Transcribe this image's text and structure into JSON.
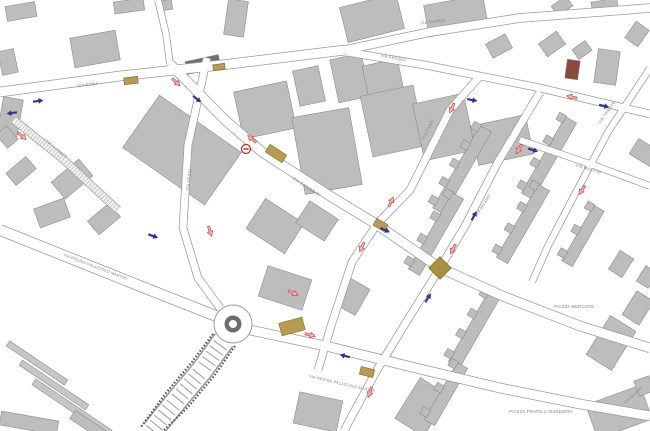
{
  "map": {
    "canvas": {
      "w": 650,
      "h": 431,
      "bg": "#ffffff"
    },
    "palette": {
      "building_fill": "#bdbdbd",
      "building_stroke": "#878787",
      "road_casing": "#9a9a9a",
      "road_fill": "#ffffff",
      "marker_gold": "#b89a50",
      "marker_gold_dark": "#a98f3c",
      "arrow_blue": "#2b3990",
      "arrow_red_fill": "#f2b3b3",
      "arrow_red_stroke": "#cf3333",
      "label_color": "#808080",
      "roundabout_ring": "#6e6e6e"
    },
    "roads": [
      {
        "id": "via-roma",
        "pts": [
          [
            0,
            92
          ],
          [
            120,
            76
          ],
          [
            230,
            64
          ],
          [
            345,
            50
          ]
        ],
        "w": 9
      },
      {
        "id": "via-suardi",
        "pts": [
          [
            345,
            50
          ],
          [
            430,
            32
          ],
          [
            520,
            18
          ],
          [
            650,
            8
          ]
        ],
        "w": 8
      },
      {
        "id": "via-reggio",
        "pts": [
          [
            347,
            52
          ],
          [
            430,
            66
          ],
          [
            540,
            88
          ],
          [
            650,
            114
          ]
        ],
        "w": 7
      },
      {
        "id": "via-garibaldi-main",
        "pts": [
          [
            170,
            64
          ],
          [
            225,
            120
          ],
          [
            262,
            152
          ],
          [
            330,
            196
          ],
          [
            376,
            224
          ],
          [
            440,
            268
          ],
          [
            505,
            297
          ],
          [
            580,
            326
          ],
          [
            650,
            348
          ]
        ],
        "w": 9
      },
      {
        "id": "via-verdi",
        "pts": [
          [
            207,
            58
          ],
          [
            188,
            145
          ],
          [
            183,
            228
          ],
          [
            198,
            278
          ],
          [
            220,
            308
          ]
        ],
        "w": 7
      },
      {
        "id": "via-fiume",
        "pts": [
          [
            480,
            76
          ],
          [
            450,
            110
          ],
          [
            410,
            190
          ],
          [
            377,
            224
          ],
          [
            352,
            262
          ],
          [
            331,
            326
          ],
          [
            318,
            370
          ]
        ],
        "w": 7
      },
      {
        "id": "via-milano",
        "pts": [
          [
            540,
            92
          ],
          [
            498,
            162
          ],
          [
            465,
            226
          ],
          [
            440,
            268
          ],
          [
            410,
            316
          ],
          [
            377,
            370
          ],
          [
            354,
            412
          ],
          [
            344,
            431
          ]
        ],
        "w": 7
      },
      {
        "id": "via-trieste",
        "pts": [
          [
            650,
            68
          ],
          [
            608,
            132
          ],
          [
            574,
            196
          ],
          [
            548,
            246
          ],
          [
            532,
            282
          ]
        ],
        "w": 6
      },
      {
        "id": "via-mazzini",
        "pts": [
          [
            520,
            140
          ],
          [
            590,
            164
          ],
          [
            650,
            186
          ]
        ],
        "w": 6
      },
      {
        "id": "via-regina-west",
        "pts": [
          [
            0,
            230
          ],
          [
            80,
            262
          ],
          [
            150,
            290
          ],
          [
            216,
            316
          ]
        ],
        "w": 10
      },
      {
        "id": "via-regina-east",
        "pts": [
          [
            250,
            330
          ],
          [
            330,
            347
          ],
          [
            420,
            369
          ],
          [
            500,
            388
          ],
          [
            580,
            404
          ],
          [
            650,
            416
          ]
        ],
        "w": 9
      },
      {
        "id": "north-stub",
        "pts": [
          [
            158,
            0
          ],
          [
            166,
            34
          ],
          [
            170,
            64
          ]
        ],
        "w": 6
      }
    ],
    "stair_street": {
      "pts": [
        [
          14,
          120
        ],
        [
          64,
          160
        ],
        [
          118,
          210
        ]
      ],
      "w": 7,
      "step": 3,
      "rung": 7
    },
    "bridge": {
      "pts": [
        [
          224,
          340
        ],
        [
          203,
          369
        ],
        [
          177,
          400
        ],
        [
          152,
          431
        ]
      ],
      "w": 20,
      "step": 6.5,
      "rung": 16,
      "rails": [
        [
          [
            213,
            334
          ],
          [
            192,
            362
          ],
          [
            166,
            393
          ],
          [
            141,
            427
          ]
        ],
        [
          [
            235,
            346
          ],
          [
            214,
            376
          ],
          [
            188,
            407
          ],
          [
            163,
            431
          ]
        ]
      ]
    },
    "roundabout": {
      "cx": 233,
      "cy": 324,
      "r_outer": 19,
      "r_ring": 8.5,
      "r_inner": 4
    },
    "buildings": [
      [
        6,
        4,
        30,
        15,
        -10
      ],
      [
        114,
        0,
        30,
        12,
        -8
      ],
      [
        72,
        34,
        46,
        30,
        -10
      ],
      [
        0,
        50,
        16,
        24,
        -12
      ],
      [
        226,
        0,
        20,
        36,
        8
      ],
      [
        160,
        0,
        12,
        10,
        -8
      ],
      [
        132,
        118,
        100,
        64,
        35
      ],
      [
        186,
        58,
        34,
        13,
        -12,
        "#6f6f6f"
      ],
      [
        238,
        86,
        54,
        48,
        -12
      ],
      [
        296,
        68,
        26,
        36,
        -12
      ],
      [
        343,
        0,
        58,
        36,
        -14
      ],
      [
        426,
        0,
        60,
        32,
        -10
      ],
      [
        334,
        56,
        32,
        44,
        -12
      ],
      [
        366,
        62,
        36,
        42,
        -12
      ],
      [
        488,
        38,
        22,
        16,
        -28
      ],
      [
        541,
        36,
        22,
        16,
        -35
      ],
      [
        574,
        44,
        16,
        12,
        -35
      ],
      [
        566,
        60,
        13,
        19,
        8,
        "#8a4a3c"
      ],
      [
        596,
        50,
        22,
        34,
        8
      ],
      [
        553,
        0,
        18,
        12,
        -35
      ],
      [
        592,
        0,
        26,
        14,
        -10
      ],
      [
        627,
        26,
        20,
        16,
        -55
      ],
      [
        636,
        140,
        18,
        26,
        -58
      ],
      [
        298,
        112,
        58,
        78,
        -10
      ],
      [
        366,
        90,
        54,
        62,
        -12
      ],
      [
        418,
        98,
        52,
        58,
        -12
      ],
      [
        474,
        120,
        56,
        40,
        -12
      ],
      [
        252,
        208,
        46,
        36,
        33
      ],
      [
        262,
        272,
        46,
        32,
        18
      ],
      [
        300,
        208,
        34,
        26,
        33
      ],
      [
        0,
        98,
        20,
        40,
        10
      ],
      [
        8,
        163,
        26,
        16,
        -40
      ],
      [
        54,
        168,
        36,
        22,
        -40
      ],
      [
        90,
        210,
        28,
        18,
        -40
      ],
      [
        0,
        128,
        14,
        18,
        -40
      ],
      [
        36,
        203,
        32,
        20,
        -20
      ],
      [
        2,
        360,
        70,
        6,
        34,
        "#c6c6c6"
      ],
      [
        14,
        382,
        80,
        6,
        34,
        "#c6c6c6"
      ],
      [
        26,
        404,
        92,
        7,
        34,
        "#c6c6c6"
      ],
      [
        0,
        416,
        58,
        14,
        10
      ],
      [
        68,
        424,
        52,
        10,
        34
      ],
      [
        296,
        396,
        44,
        32,
        12
      ],
      [
        398,
        390,
        48,
        34,
        -58
      ],
      [
        590,
        394,
        58,
        36,
        -20
      ],
      [
        636,
        378,
        16,
        16,
        -20
      ],
      [
        588,
        328,
        46,
        30,
        -58
      ],
      [
        624,
        298,
        28,
        20,
        -58
      ],
      [
        610,
        256,
        22,
        16,
        -58
      ],
      [
        638,
        270,
        18,
        14,
        -58
      ],
      [
        338,
        286,
        30,
        22,
        -60
      ]
    ],
    "comb_buildings": [
      {
        "cx": 462,
        "cy": 170,
        "len": 95,
        "w": 13,
        "rot": -60,
        "teeth": 5
      },
      {
        "cx": 436,
        "cy": 234,
        "len": 88,
        "w": 13,
        "rot": -60,
        "teeth": 4
      },
      {
        "cx": 549,
        "cy": 158,
        "len": 88,
        "w": 13,
        "rot": -60,
        "teeth": 4
      },
      {
        "cx": 523,
        "cy": 224,
        "len": 84,
        "w": 13,
        "rot": -60,
        "teeth": 4
      },
      {
        "cx": 583,
        "cy": 236,
        "len": 64,
        "w": 12,
        "rot": -60,
        "teeth": 3
      },
      {
        "cx": 474,
        "cy": 330,
        "len": 80,
        "w": 13,
        "rot": -60,
        "teeth": 4
      },
      {
        "cx": 446,
        "cy": 394,
        "len": 66,
        "w": 12,
        "rot": -60,
        "teeth": 3
      }
    ],
    "crossing_markers": [
      [
        124,
        77,
        14,
        7,
        -7
      ],
      [
        213,
        64,
        12,
        6,
        -8
      ],
      [
        266,
        149,
        20,
        9,
        33
      ],
      [
        374,
        221,
        13,
        8,
        30
      ],
      [
        280,
        320,
        24,
        13,
        -15
      ],
      [
        360,
        368,
        14,
        8,
        14
      ]
    ],
    "junction_diamond": {
      "cx": 440,
      "cy": 268,
      "size": 16
    },
    "arrows": [
      [
        38,
        101,
        -8,
        "blue"
      ],
      [
        12,
        113,
        172,
        "blue"
      ],
      [
        22,
        136,
        40,
        "red"
      ],
      [
        176,
        82,
        42,
        "red"
      ],
      [
        197,
        99,
        38,
        "blue"
      ],
      [
        252,
        139,
        218,
        "red"
      ],
      [
        385,
        230,
        24,
        "blue"
      ],
      [
        391,
        202,
        -65,
        "red"
      ],
      [
        362,
        247,
        115,
        "red"
      ],
      [
        453,
        249,
        118,
        "red"
      ],
      [
        474,
        216,
        -62,
        "blue"
      ],
      [
        452,
        108,
        115,
        "red"
      ],
      [
        472,
        100,
        11,
        "blue"
      ],
      [
        533,
        150,
        16,
        "blue"
      ],
      [
        519,
        149,
        122,
        "red"
      ],
      [
        604,
        106,
        13,
        "blue"
      ],
      [
        572,
        97,
        193,
        "red"
      ],
      [
        210,
        231,
        72,
        "red"
      ],
      [
        153,
        236,
        20,
        "blue"
      ],
      [
        293,
        293,
        25,
        "red"
      ],
      [
        310,
        335,
        14,
        "red"
      ],
      [
        345,
        356,
        194,
        "blue"
      ],
      [
        370,
        392,
        108,
        "red"
      ],
      [
        582,
        190,
        122,
        "red"
      ],
      [
        428,
        298,
        -58,
        "blue"
      ]
    ],
    "no_entry_signs": [
      {
        "x": 246,
        "y": 149
      }
    ],
    "labels": [
      {
        "t": "VIA ROMA",
        "x": 88,
        "y": 86,
        "r": -7,
        "s": 4
      },
      {
        "t": "VIA SUARDI",
        "x": 433,
        "y": 23,
        "r": -7,
        "s": 4
      },
      {
        "t": "VIA REGGIO",
        "x": 393,
        "y": 59,
        "r": 11,
        "s": 4
      },
      {
        "t": "VIA GARIBALDI",
        "x": 306,
        "y": 188,
        "r": 33,
        "s": 4
      },
      {
        "t": "VIA FIUME",
        "x": 429,
        "y": 130,
        "r": -63,
        "s": 4
      },
      {
        "t": "VIA MILANO",
        "x": 484,
        "y": 206,
        "r": -58,
        "s": 4
      },
      {
        "t": "VIA TRIESTE",
        "x": 608,
        "y": 113,
        "r": -55,
        "s": 4
      },
      {
        "t": "VIA MAZZINI",
        "x": 588,
        "y": 170,
        "r": 16,
        "s": 4
      },
      {
        "t": "VIA REGINA PALAZZOLO MARTIRI",
        "x": 95,
        "y": 268,
        "r": 21,
        "s": 3.8
      },
      {
        "t": "VIA REGINA PALAZZOLO MARTIRI",
        "x": 342,
        "y": 385,
        "r": 13,
        "s": 3.8
      },
      {
        "t": "PIAZZA MERCATO",
        "x": 574,
        "y": 308,
        "r": 0,
        "s": 4.2
      },
      {
        "t": "PIAZZA FRATELLI BANDIERA",
        "x": 541,
        "y": 413,
        "r": 0,
        "s": 4.2
      },
      {
        "t": "VIA GUADO",
        "x": 634,
        "y": 396,
        "r": -42,
        "s": 3.8
      },
      {
        "t": "VIA VERDI",
        "x": 190,
        "y": 180,
        "r": -82,
        "s": 4
      },
      {
        "t": "VIA AL PONTE",
        "x": 56,
        "y": 150,
        "r": 40,
        "s": 3.6
      }
    ]
  }
}
